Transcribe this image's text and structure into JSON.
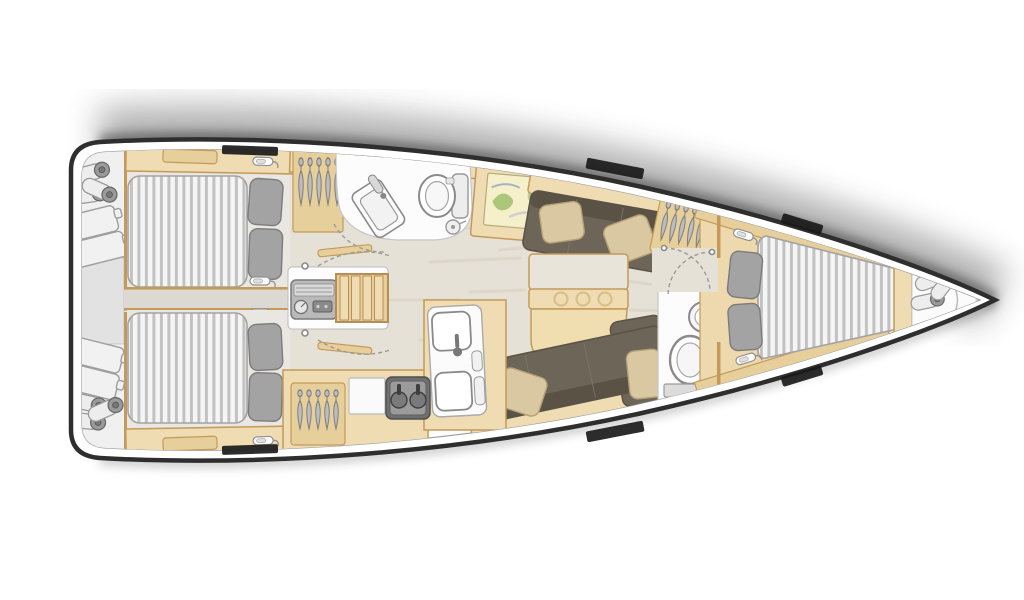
{
  "title": "Sailing yacht interior layout floor plan, top view, bow pointing right",
  "diagram_type": "yacht-floor-plan",
  "layout_inventory": {
    "cabins": 3,
    "heads": 2,
    "double_berths": 3,
    "areas": [
      {
        "name": "stern-storage",
        "contents": [
          "fenders",
          "folded-covers",
          "transom-locker"
        ]
      },
      {
        "name": "aft-cabin-top",
        "contents": [
          "double-berth",
          "two-gray-pillows",
          "shelf-band",
          "deck-hatch"
        ]
      },
      {
        "name": "aft-cabin-bottom",
        "contents": [
          "double-berth",
          "two-gray-pillows",
          "shelf-band",
          "deck-hatch"
        ]
      },
      {
        "name": "companionway",
        "contents": [
          "engine-compartment",
          "wooden-steps",
          "cabin-doors",
          "door-swing-arcs"
        ]
      },
      {
        "name": "aft-head",
        "contents": [
          "hanging-locker",
          "angled-sink",
          "toilet",
          "round-knob"
        ]
      },
      {
        "name": "galley",
        "contents": [
          "hanging-locker",
          "white-cabinet",
          "two-burner-stove",
          "double-sink-unit",
          "wood-counters"
        ]
      },
      {
        "name": "salon",
        "contents": [
          "nav-chart-table",
          "upper-settee",
          "lower-l-settee",
          "beige-pillows",
          "dining-table-with-cupholders",
          "hanging-locker"
        ]
      },
      {
        "name": "forward-head",
        "contents": [
          "round-sink",
          "toilet"
        ]
      },
      {
        "name": "forward-cabin",
        "contents": [
          "v-berth",
          "two-gray-pillows",
          "shelf-bands",
          "latches"
        ]
      },
      {
        "name": "bow-locker",
        "contents": [
          "fenders"
        ]
      }
    ],
    "hull_windows_per_side": 3
  },
  "colors": {
    "background": "#ffffff",
    "hull_outline": "#2e2e2e",
    "rim_line": "#9a9a9a",
    "shadow": "#4a4a4a",
    "wood": "#efdcb2",
    "wood_mid": "#e7cf9c",
    "wood_dark": "#c49a5a",
    "floor": "#e6e1d6",
    "floor_cabin": "#eae7e2",
    "corridor": "#dcd9d2",
    "mattress": "#f5f5f5",
    "mattress_stripe": "#c2c2c2",
    "mattress_edge": "#a3a3a3",
    "pillow_gray": "#a3a3a3",
    "pillow_gray_edge": "#7c7c7c",
    "pillow_beige": "#d9c8a2",
    "pillow_beige_edge": "#b3a077",
    "settee": "#6d6557",
    "settee_dark": "#5a5345",
    "fixture_white": "#fcfcfc",
    "fixture_edge": "#8a8a8a",
    "appliance_dark": "#6f6f6f",
    "appliance_mid": "#9b9b9b",
    "metal_gray": "#b9b9b9",
    "window_black": "#1a1a1a",
    "map_bg": "#f5efca",
    "map_green": "#9fc06c",
    "map_blue": "#8fa7bf"
  }
}
